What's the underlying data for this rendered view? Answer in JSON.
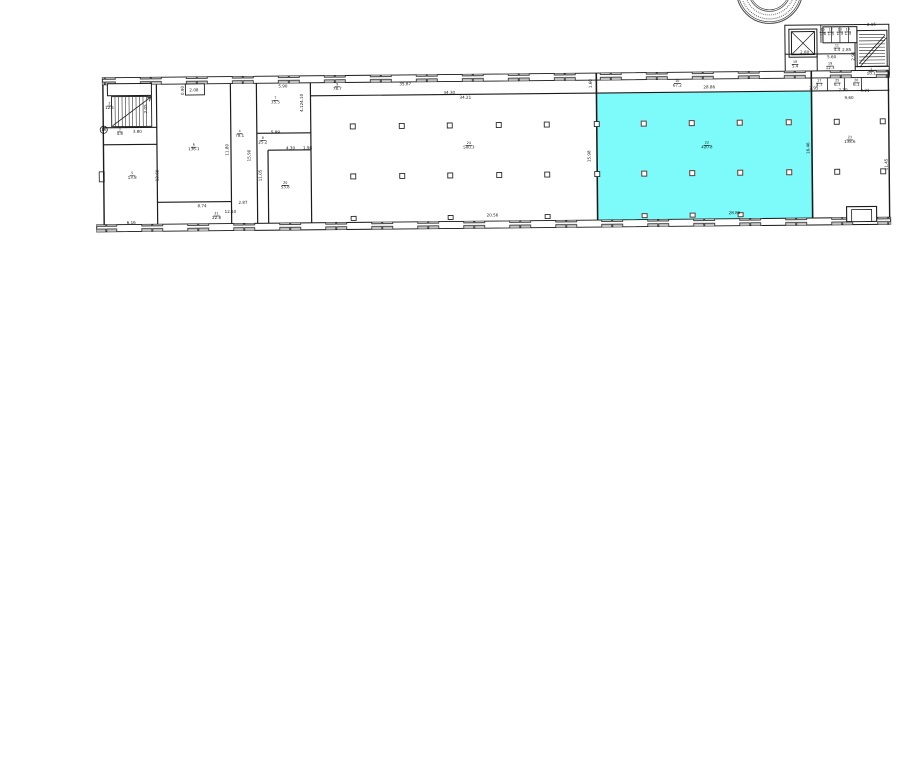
{
  "plan": {
    "colors": {
      "highlight": "#7DFBFB",
      "line": "#1b1b1b"
    },
    "grid_marker": "16",
    "rooms": [
      {
        "n": "2",
        "a": "12.5"
      },
      {
        "n": "3",
        "a": "4.8"
      },
      {
        "n": "5",
        "a": "13.8"
      },
      {
        "n": "6",
        "a": "136.1"
      },
      {
        "n": "4",
        "a": "78.1"
      },
      {
        "n": "7",
        "a": "35.5"
      },
      {
        "n": "8",
        "a": "25.2"
      },
      {
        "n": "20",
        "a": "53.8"
      },
      {
        "n": "21",
        "a": "22.8"
      },
      {
        "n": "24",
        "a": "500.3"
      },
      {
        "n": "9",
        "a": "78.7"
      },
      {
        "n": "10",
        "a": "67.2"
      },
      {
        "n": "22",
        "a": "420.8"
      },
      {
        "n": "23",
        "a": "138.6"
      },
      {
        "n": "18",
        "a": "5.4"
      },
      {
        "n": "19",
        "a": "12.3"
      },
      {
        "n": "1",
        "a": "10.1"
      },
      {
        "n": "11",
        "a": "4.4"
      },
      {
        "n": "15",
        "a": "1.6"
      },
      {
        "n": "12",
        "a": "1.5"
      },
      {
        "n": "13",
        "a": "1.3"
      },
      {
        "n": "14",
        "a": "1.3"
      },
      {
        "n": "17",
        "a": "4.7"
      },
      {
        "n": "25",
        "a": "6.7"
      },
      {
        "n": "26",
        "a": "6.1"
      }
    ],
    "dims": [
      {
        "t": "2.08"
      },
      {
        "t": "0.90"
      },
      {
        "t": "2.05"
      },
      {
        "t": "3.80"
      },
      {
        "t": "5.90"
      },
      {
        "t": "35.87"
      },
      {
        "t": "34.30"
      },
      {
        "t": "34.21"
      },
      {
        "t": "28.86"
      },
      {
        "t": "1.60"
      },
      {
        "t": "2.95"
      },
      {
        "t": "2.70"
      },
      {
        "t": "3.21"
      },
      {
        "t": "9.60"
      },
      {
        "t": "2.15"
      },
      {
        "t": "2.80"
      },
      {
        "t": "2.85"
      },
      {
        "t": "5.60"
      },
      {
        "t": "2.90"
      },
      {
        "t": "6.16"
      },
      {
        "t": "8.74"
      },
      {
        "t": "12.10"
      },
      {
        "t": "2.87"
      },
      {
        "t": "20.56"
      },
      {
        "t": "28.86"
      },
      {
        "t": "12.60"
      },
      {
        "t": "11.80"
      },
      {
        "t": "15.90"
      },
      {
        "t": "11.05"
      },
      {
        "t": "4.10"
      },
      {
        "t": "4.12"
      },
      {
        "t": "5.99"
      },
      {
        "t": "4.30"
      },
      {
        "t": "1.98"
      },
      {
        "t": "15.98"
      },
      {
        "t": "16.46"
      },
      {
        "t": "11.45"
      }
    ]
  }
}
